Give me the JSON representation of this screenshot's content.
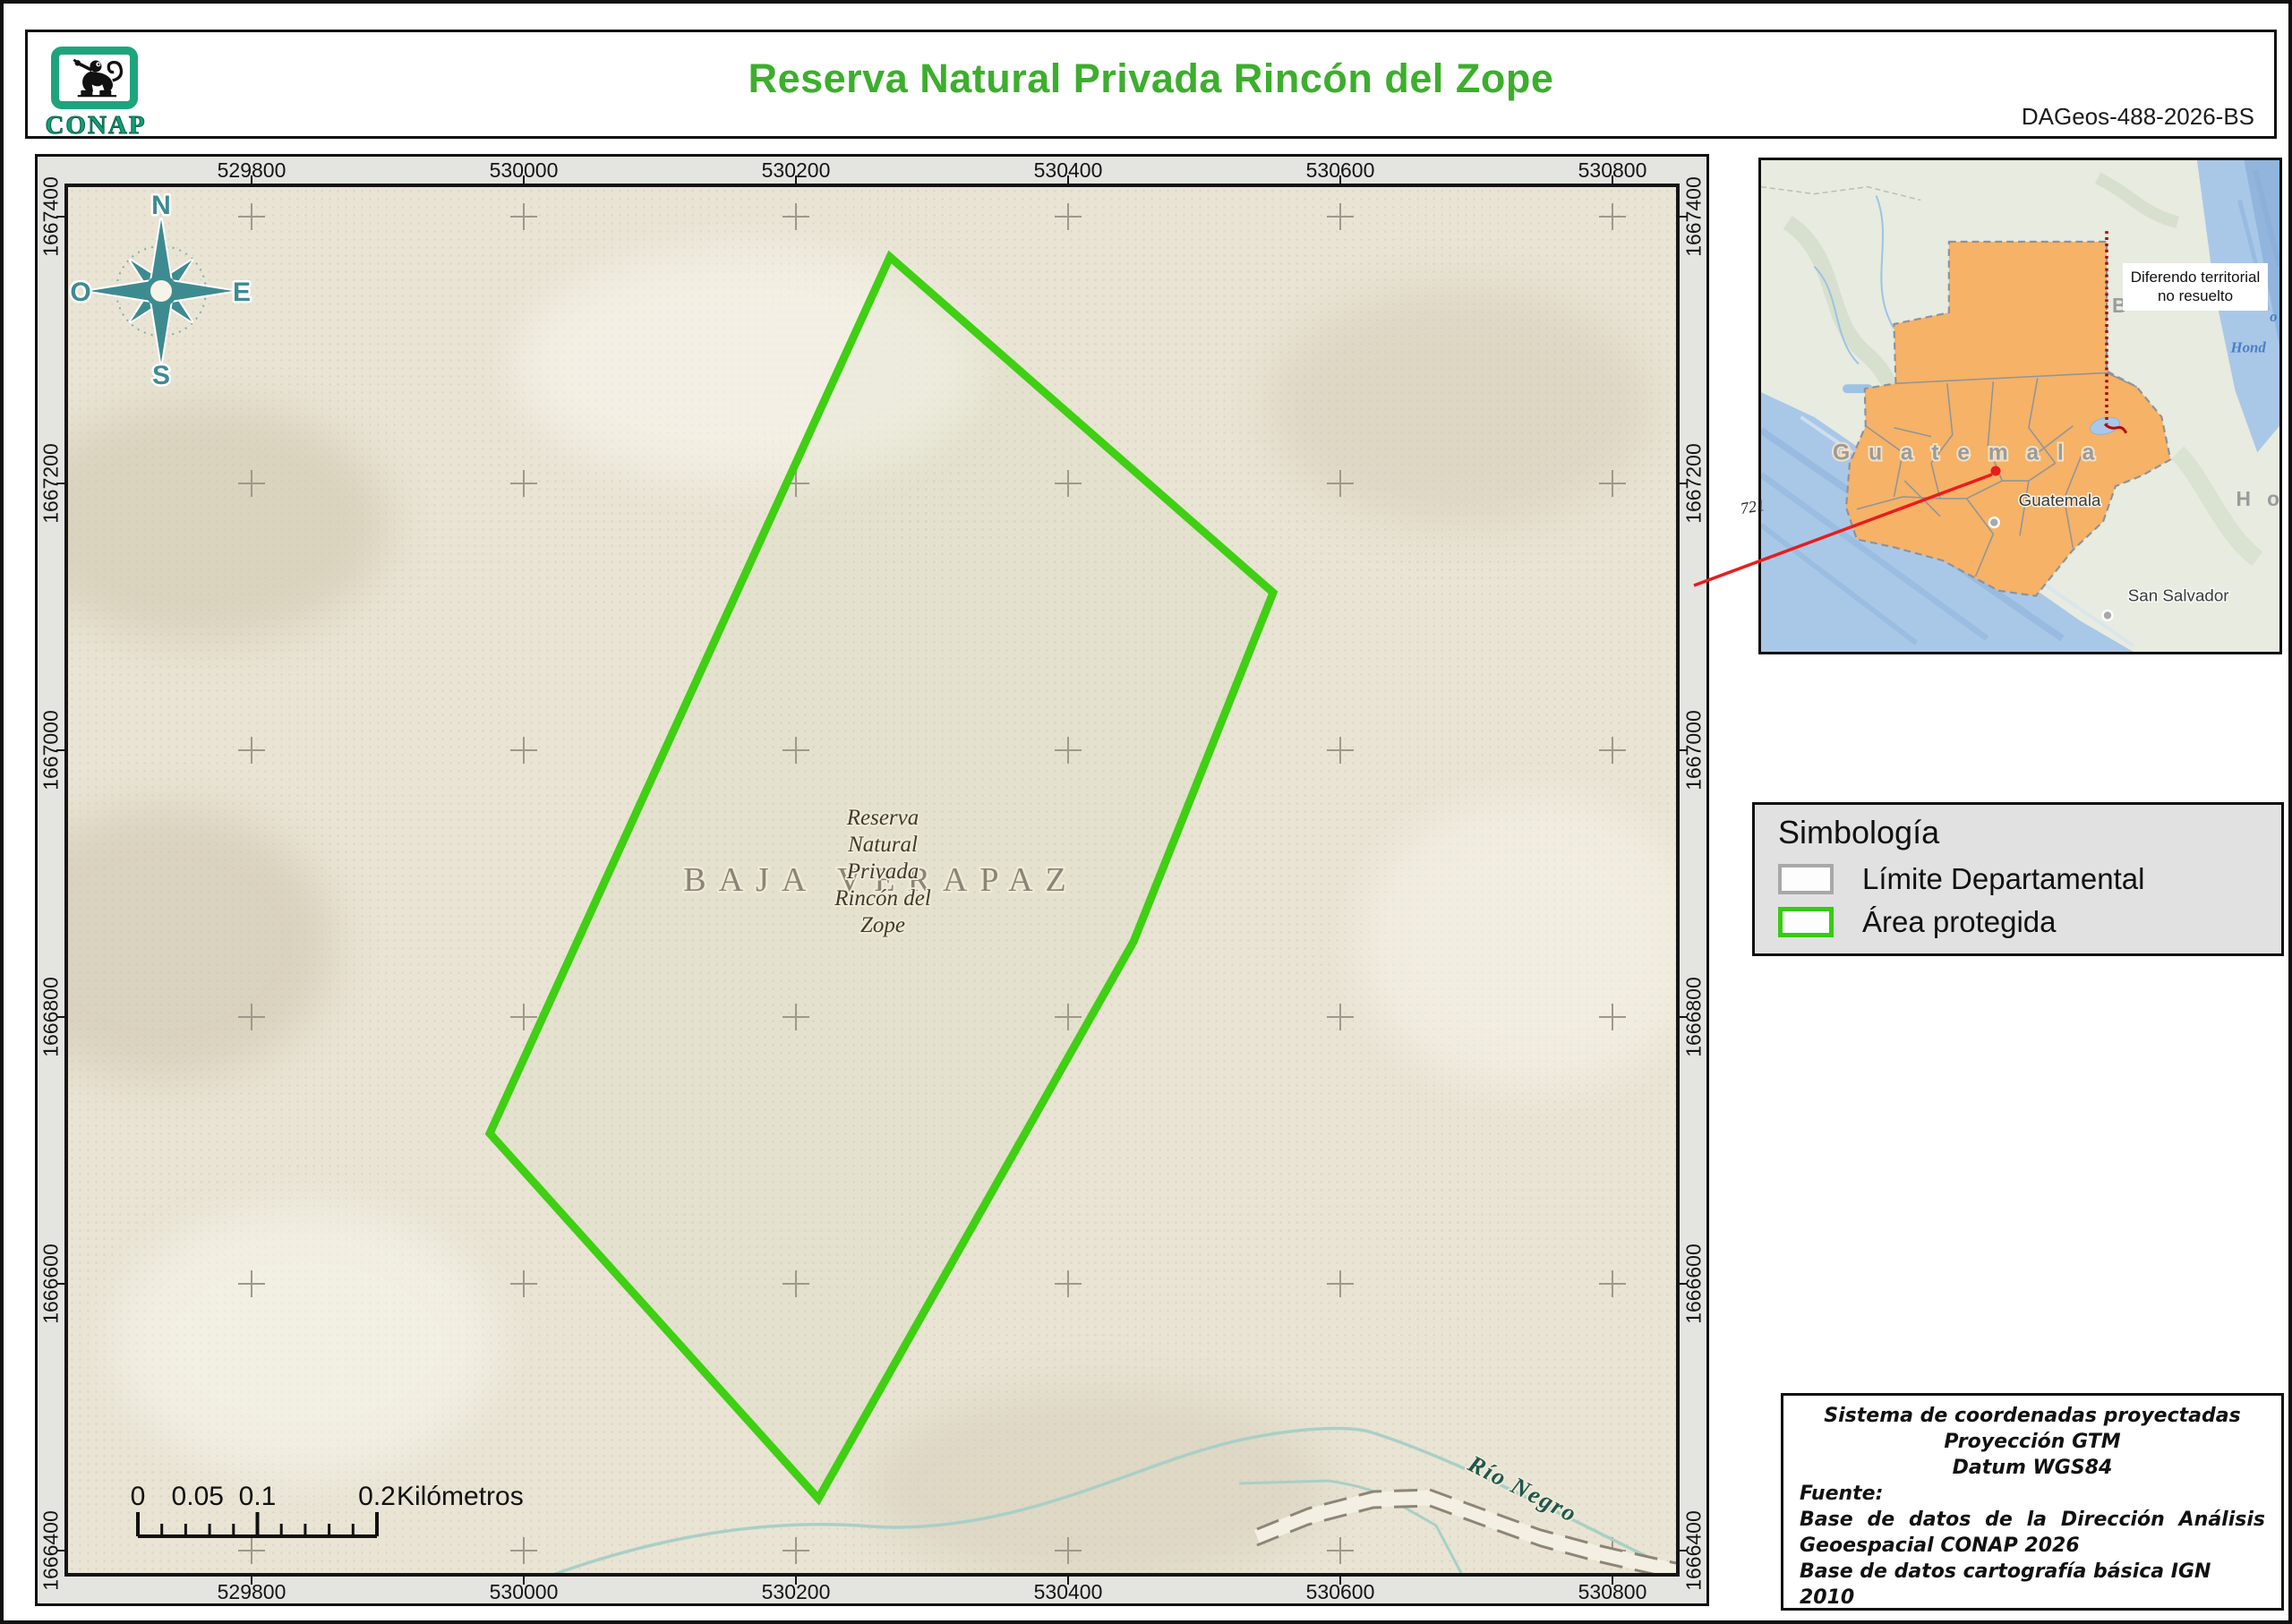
{
  "header": {
    "logo_text": "CONAP",
    "title": "Reserva Natural Privada Rincón del Zope",
    "doc_id": "DAGeos-488-2026-BS"
  },
  "map_frame": {
    "x_labels": [
      "529800",
      "530000",
      "530200",
      "530400",
      "530600",
      "530800"
    ],
    "y_labels": [
      "1667400",
      "1667200",
      "1667000",
      "1666800",
      "1666600",
      "1666400"
    ]
  },
  "map": {
    "department_label": "BAJA VERAPAZ",
    "reserve_label_lines": [
      "Reserva",
      "Natural",
      "Privada",
      "Rincón del",
      "Zope"
    ],
    "river_label": "Río Negro",
    "compass": {
      "north": "N",
      "east": "E",
      "south": "S",
      "west": "O"
    },
    "scale_bar": {
      "labels": [
        "0",
        "0.05",
        "0.1",
        "0.2"
      ],
      "unit": "Kilómetros"
    }
  },
  "inset": {
    "country_label": "G u a t e m a l a",
    "capital_label": "Guatemala",
    "city_label": "San Salvador",
    "honduras_fragment": "H o",
    "belize_fragment": "B",
    "water_fragment_1": "Gu",
    "water_fragment_2": "o",
    "water_fragment_3": "Hond",
    "territorial_note": "Diferendo territorial no resuelto",
    "road_ref": "721"
  },
  "legend": {
    "title": "Simbología",
    "items": [
      {
        "label": "Límite Departamental",
        "color": "#a8a8a8"
      },
      {
        "label": "Área protegida",
        "color": "#35cc10"
      }
    ]
  },
  "credits": {
    "line1": "Sistema de coordenadas proyectadas",
    "line2": "Proyección GTM",
    "line3": "Datum WGS84",
    "fuente": "Fuente:",
    "source1": "Base de datos de la Dirección Análisis Geoespacial CONAP 2026",
    "source2": "Base de datos cartografía básica IGN 2010"
  },
  "colors": {
    "title_green": "#3cae2c",
    "protected_green": "#3fcf13",
    "compass_teal": "#3d8b90",
    "river_teal": "#a9cfc7",
    "guatemala_orange": "#f6b266",
    "sea_blue": "#a9c8e8",
    "logo_green": "#1ea47c",
    "locator_red": "#ea1c1c",
    "dispute_red": "#9c1006"
  }
}
